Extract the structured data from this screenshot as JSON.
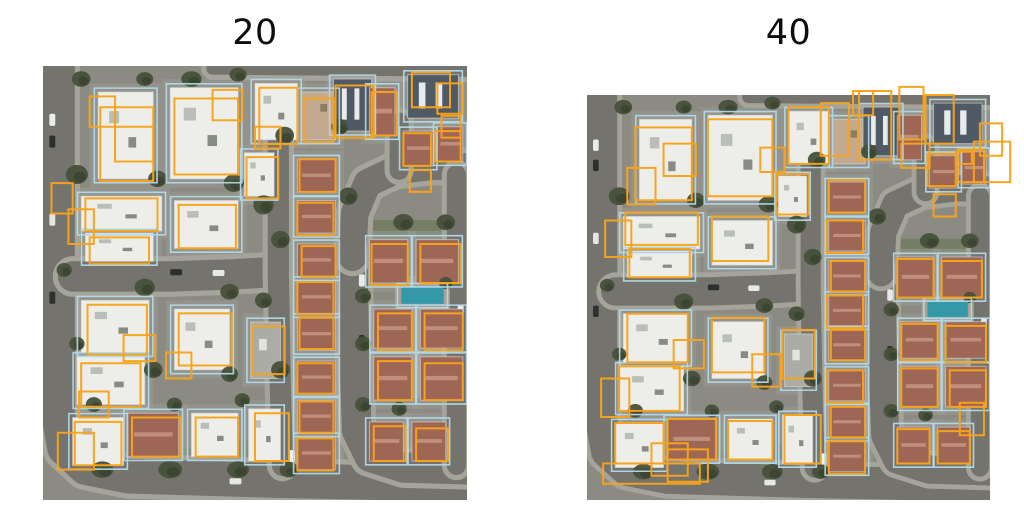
{
  "panels": [
    {
      "title": "20",
      "predicted_boxes": [
        [
          13.5,
          9.5,
          12.5,
          17
        ],
        [
          11,
          7,
          6,
          7
        ],
        [
          17,
          14,
          9,
          8
        ],
        [
          31,
          7.5,
          15,
          17.5
        ],
        [
          40,
          5.5,
          7,
          7
        ],
        [
          51,
          5,
          9,
          13
        ],
        [
          50,
          14,
          6,
          5
        ],
        [
          61.5,
          7.5,
          7,
          10
        ],
        [
          69,
          4.5,
          9,
          12
        ],
        [
          77.5,
          6,
          6,
          10
        ],
        [
          87,
          1.5,
          9,
          8
        ],
        [
          93,
          4,
          6,
          7
        ],
        [
          94,
          11.5,
          4.5,
          5
        ],
        [
          85,
          15.5,
          6.5,
          7.5
        ],
        [
          92.5,
          15,
          6,
          7
        ],
        [
          86.5,
          24,
          5,
          5
        ],
        [
          10,
          30.5,
          17,
          7.5
        ],
        [
          11,
          39.5,
          14,
          6
        ],
        [
          6,
          33,
          6,
          8
        ],
        [
          32,
          32,
          13.5,
          10
        ],
        [
          48,
          21,
          7.5,
          9.5
        ],
        [
          60.5,
          21.5,
          8.5,
          7.5
        ],
        [
          60,
          31.5,
          8.5,
          7.5
        ],
        [
          61,
          41.5,
          8,
          7
        ],
        [
          60,
          49.8,
          8.5,
          7.4
        ],
        [
          60.5,
          58,
          8,
          7.2
        ],
        [
          60,
          68.5,
          8.5,
          7
        ],
        [
          60.5,
          77.3,
          8,
          7.2
        ],
        [
          60,
          85.8,
          8.5,
          7.4
        ],
        [
          10.5,
          55,
          14,
          11.5
        ],
        [
          19,
          62,
          7.5,
          6
        ],
        [
          32,
          57,
          12.5,
          12
        ],
        [
          29,
          66,
          6,
          6
        ],
        [
          49.5,
          60,
          7.5,
          11
        ],
        [
          9,
          68.5,
          14,
          10
        ],
        [
          8.5,
          75,
          7,
          6
        ],
        [
          7.5,
          82,
          11,
          10
        ],
        [
          3.5,
          84.5,
          8.5,
          8.5
        ],
        [
          21,
          81,
          11.5,
          9
        ],
        [
          36,
          81,
          10,
          9
        ],
        [
          50,
          80,
          8,
          11
        ],
        [
          77.5,
          41,
          8.5,
          9.5
        ],
        [
          89,
          41,
          9.5,
          9
        ],
        [
          79,
          57,
          8,
          8.5
        ],
        [
          90,
          57,
          9,
          8.5
        ],
        [
          79,
          68,
          8,
          9
        ],
        [
          90,
          68.5,
          9,
          8.5
        ],
        [
          78,
          83,
          7.5,
          8
        ],
        [
          88,
          83.5,
          7.5,
          7.5
        ],
        [
          2,
          27,
          5,
          7
        ]
      ]
    },
    {
      "title": "40",
      "predicted_boxes": [
        [
          12,
          8,
          14,
          18
        ],
        [
          10,
          18,
          7,
          9
        ],
        [
          19,
          12,
          8,
          8
        ],
        [
          30,
          6,
          16,
          19
        ],
        [
          43,
          13,
          6,
          6
        ],
        [
          50,
          3,
          10,
          14
        ],
        [
          58,
          2,
          7,
          13
        ],
        [
          67.5,
          -1,
          8,
          17
        ],
        [
          77.5,
          -2,
          6,
          13
        ],
        [
          66,
          -1,
          5,
          6
        ],
        [
          84,
          0,
          7,
          12
        ],
        [
          91.5,
          14,
          4,
          3
        ],
        [
          78,
          12,
          7,
          6
        ],
        [
          97.5,
          7,
          5.5,
          8
        ],
        [
          96,
          11.5,
          9,
          10
        ],
        [
          84.5,
          14.5,
          7,
          8
        ],
        [
          92,
          13.5,
          6.5,
          8
        ],
        [
          86,
          24.5,
          5.5,
          5.5
        ],
        [
          9.5,
          29,
          18,
          8
        ],
        [
          10.5,
          38,
          15,
          7
        ],
        [
          4.5,
          31,
          6.5,
          9
        ],
        [
          31,
          30,
          14,
          11
        ],
        [
          47,
          19.5,
          8,
          10
        ],
        [
          60,
          21,
          9,
          8
        ],
        [
          59.5,
          31,
          9,
          8
        ],
        [
          60.5,
          41,
          8.5,
          7.5
        ],
        [
          59.5,
          49.5,
          9,
          8
        ],
        [
          60.5,
          58,
          8.5,
          7.5
        ],
        [
          59.5,
          68,
          9,
          8
        ],
        [
          60.5,
          77,
          8.5,
          7.5
        ],
        [
          60,
          85.5,
          9,
          8
        ],
        [
          10,
          54,
          15,
          12
        ],
        [
          21.5,
          60.5,
          7.5,
          7
        ],
        [
          31,
          55,
          13,
          13.5
        ],
        [
          41,
          64,
          7,
          8
        ],
        [
          48.5,
          58,
          8,
          12
        ],
        [
          8,
          67,
          15,
          11
        ],
        [
          3.5,
          70,
          7,
          9.5
        ],
        [
          7,
          81,
          12,
          10
        ],
        [
          16,
          86,
          9,
          8
        ],
        [
          20,
          80,
          12,
          10
        ],
        [
          20,
          87.5,
          10,
          8
        ],
        [
          35,
          80.5,
          11,
          9.5
        ],
        [
          49,
          79,
          9,
          12
        ],
        [
          4,
          91,
          24,
          5
        ],
        [
          77,
          40.5,
          9,
          9.5
        ],
        [
          88,
          41,
          10,
          9
        ],
        [
          78,
          56.5,
          9,
          9
        ],
        [
          89,
          57,
          10,
          9
        ],
        [
          78,
          67.5,
          9,
          9.5
        ],
        [
          90,
          68,
          9,
          9
        ],
        [
          77,
          82.5,
          8,
          8.5
        ],
        [
          87,
          83,
          8,
          8
        ],
        [
          92.5,
          76,
          6,
          8
        ]
      ]
    }
  ],
  "colors": {
    "prediction_orange": "#F9A31B",
    "ground_truth_cyan": "#B2D9E8",
    "ground": "#8C8B83",
    "lot_pad": "#9C9B93",
    "road": "#74736D",
    "curb": "#A5A49B",
    "lawn": "#6F7A5E",
    "tree": "#47503A",
    "tree_dark": "#3A422F",
    "pool": "#3498A8",
    "pave": "#A9A296",
    "roof_white": "#EDEEE9",
    "roof_terra": "#9E6655",
    "roof_tan": "#C2A98F",
    "roof_slate": "#4F5A64",
    "roof_gray": "#ABACA6",
    "detail_gray": "#B9BEB8",
    "detail_dark": "#868B83",
    "terra_ridge": "#BF8F7B",
    "slate_panel": "#E8EBEC",
    "tan_dark": "#8D7C64",
    "gray_light": "#E2E3DF",
    "title_color": "#0D0D0D"
  },
  "scene": {
    "houses": [
      {
        "r": [
          13,
          6,
          13,
          20
        ],
        "c": "white"
      },
      {
        "r": [
          30,
          5,
          16,
          21
        ],
        "c": "white"
      },
      {
        "r": [
          50,
          4,
          10,
          13
        ],
        "c": "white"
      },
      {
        "r": [
          61,
          6,
          8,
          11
        ],
        "c": "tan"
      },
      {
        "r": [
          68.5,
          3,
          9,
          12
        ],
        "c": "slate"
      },
      {
        "r": [
          77,
          5,
          6,
          11
        ],
        "c": "terra"
      },
      {
        "r": [
          86,
          2,
          12,
          10
        ],
        "c": "slate"
      },
      {
        "r": [
          85,
          15,
          7,
          8
        ],
        "c": "terra"
      },
      {
        "r": [
          93,
          14,
          6,
          8
        ],
        "c": "terra"
      },
      {
        "r": [
          9,
          30,
          19,
          8
        ],
        "c": "white"
      },
      {
        "r": [
          10,
          38.5,
          16,
          6.5
        ],
        "c": "white"
      },
      {
        "r": [
          31,
          31,
          15,
          11
        ],
        "c": "white"
      },
      {
        "r": [
          47.5,
          20,
          7,
          10
        ],
        "c": "white"
      },
      {
        "r": [
          60,
          21.5,
          9,
          7.5
        ],
        "c": "terra"
      },
      {
        "r": [
          60,
          31,
          9,
          7.5
        ],
        "c": "terra"
      },
      {
        "r": [
          60,
          41,
          9,
          7.5
        ],
        "c": "terra"
      },
      {
        "r": [
          60,
          49.5,
          9,
          7.5
        ],
        "c": "terra"
      },
      {
        "r": [
          60,
          58,
          9,
          7.5
        ],
        "c": "terra"
      },
      {
        "r": [
          60,
          68,
          9,
          7.5
        ],
        "c": "terra"
      },
      {
        "r": [
          60,
          77,
          9,
          7.5
        ],
        "c": "terra"
      },
      {
        "r": [
          60,
          85.5,
          9,
          7.5
        ],
        "c": "terra"
      },
      {
        "r": [
          9,
          54,
          16,
          12
        ],
        "c": "white"
      },
      {
        "r": [
          31,
          56,
          13,
          14
        ],
        "c": "white"
      },
      {
        "r": [
          49,
          59,
          7,
          13
        ],
        "c": "gray"
      },
      {
        "r": [
          8,
          67,
          16,
          11
        ],
        "c": "white"
      },
      {
        "r": [
          7,
          81,
          12,
          11
        ],
        "c": "white"
      },
      {
        "r": [
          20,
          80,
          12,
          10
        ],
        "c": "terra"
      },
      {
        "r": [
          35,
          80,
          11,
          10
        ],
        "c": "white"
      },
      {
        "r": [
          48.5,
          79,
          7.5,
          12
        ],
        "c": "white"
      },
      {
        "r": [
          77,
          40,
          9,
          10
        ],
        "c": "terra"
      },
      {
        "r": [
          88,
          40,
          10,
          10
        ],
        "c": "terra"
      },
      {
        "r": [
          78,
          56,
          9,
          9
        ],
        "c": "terra"
      },
      {
        "r": [
          89,
          56,
          10,
          9
        ],
        "c": "terra"
      },
      {
        "r": [
          78,
          67,
          9,
          10
        ],
        "c": "terra"
      },
      {
        "r": [
          89,
          67,
          10,
          10
        ],
        "c": "terra"
      },
      {
        "r": [
          77,
          82,
          8,
          9
        ],
        "c": "terra"
      },
      {
        "r": [
          87,
          82,
          8,
          9
        ],
        "c": "terra"
      }
    ],
    "roads": [
      {
        "pts": [
          [
            3.5,
            -3
          ],
          [
            3.5,
            80
          ],
          [
            5,
            88
          ],
          [
            10,
            92.5
          ],
          [
            20,
            94.5
          ],
          [
            55,
            95.5
          ],
          [
            103,
            96.5
          ]
        ],
        "w": 8
      },
      {
        "pts": [
          [
            7,
            48.5
          ],
          [
            30,
            48.5
          ],
          [
            45,
            48
          ],
          [
            54,
            47.5
          ]
        ],
        "w": 7
      },
      {
        "pts": [
          [
            55.5,
            17
          ],
          [
            55.5,
            48
          ],
          [
            56,
            75
          ],
          [
            56.5,
            92
          ]
        ],
        "w": 5
      },
      {
        "pts": [
          [
            73,
            42
          ],
          [
            73.5,
            70
          ],
          [
            74,
            84
          ],
          [
            77,
            90
          ],
          [
            85,
            92.5
          ],
          [
            103,
            93
          ]
        ],
        "w": 7
      },
      {
        "pts": [
          [
            73,
            44
          ],
          [
            73.5,
            34
          ],
          [
            76.5,
            27
          ],
          [
            83,
            24
          ],
          [
            92,
            23
          ],
          [
            103,
            23.5
          ]
        ],
        "w": 6.5
      },
      {
        "pts": [
          [
            84,
            13
          ],
          [
            84,
            24
          ]
        ],
        "w": 4.5
      },
      {
        "pts": [
          [
            40,
            0.5
          ],
          [
            103,
            1
          ]
        ],
        "w": 3
      },
      {
        "pts": [
          [
            97.5,
            25
          ],
          [
            97.5,
            92
          ]
        ],
        "w": 4.5
      }
    ],
    "lawns": [
      [
        6,
        88,
        26,
        6.5
      ],
      [
        33,
        88,
        22,
        6.5
      ],
      [
        76,
        35.5,
        22,
        4
      ],
      [
        77,
        91.5,
        18,
        4
      ],
      [
        44,
        86,
        9,
        8
      ]
    ],
    "paves": [
      [
        86.5,
        56.5,
        2.5,
        20
      ],
      [
        83,
        48.5,
        13,
        8
      ]
    ],
    "pool": [
      84.5,
      51,
      10,
      3.8
    ],
    "trees": [
      [
        8,
        25,
        2.6,
        2.2
      ],
      [
        27,
        26,
        2.2,
        1.9
      ],
      [
        45,
        27,
        2.4,
        2
      ],
      [
        57,
        16,
        2.2,
        2
      ],
      [
        5,
        47,
        1.8,
        1.6
      ],
      [
        24,
        51,
        2.4,
        2
      ],
      [
        44,
        52,
        2.2,
        1.8
      ],
      [
        52,
        54,
        2,
        1.8
      ],
      [
        8,
        64,
        1.8,
        1.6
      ],
      [
        26,
        70,
        2.2,
        1.9
      ],
      [
        44,
        71,
        2,
        1.8
      ],
      [
        56,
        70,
        2.2,
        2
      ],
      [
        12,
        78,
        1.9,
        1.7
      ],
      [
        31,
        78,
        1.8,
        1.6
      ],
      [
        47,
        77,
        1.8,
        1.6
      ],
      [
        14,
        93,
        2.6,
        1.9
      ],
      [
        30,
        93,
        2.8,
        2
      ],
      [
        46,
        93,
        2.6,
        1.9
      ],
      [
        58,
        93,
        2.2,
        1.8
      ],
      [
        52,
        32,
        2.4,
        2.2
      ],
      [
        56,
        40,
        2.2,
        2
      ],
      [
        70,
        14,
        2,
        1.8
      ],
      [
        72,
        30,
        2.2,
        2
      ],
      [
        75.5,
        53,
        1.9,
        1.7
      ],
      [
        75.5,
        64,
        1.9,
        1.7
      ],
      [
        75.5,
        78,
        1.9,
        1.7
      ],
      [
        85,
        36,
        2.4,
        1.9
      ],
      [
        95,
        36,
        2.2,
        1.8
      ],
      [
        84,
        79,
        1.8,
        1.6
      ],
      [
        95,
        50,
        1.6,
        1.4
      ],
      [
        35,
        3,
        2.4,
        1.8
      ],
      [
        46,
        2,
        2,
        1.6
      ],
      [
        24,
        3,
        2,
        1.6
      ],
      [
        9,
        3,
        2.2,
        1.8
      ]
    ],
    "cars": [
      [
        1.5,
        11,
        1.4,
        2.8,
        "#ECECEC"
      ],
      [
        1.5,
        16,
        1.4,
        2.8,
        "#2E2E2E"
      ],
      [
        1.5,
        34,
        1.4,
        2.8,
        "#E5E5E5"
      ],
      [
        1.5,
        52,
        1.4,
        2.8,
        "#303030"
      ],
      [
        30,
        46.8,
        2.8,
        1.4,
        "#2E2E2E"
      ],
      [
        40,
        47,
        2.8,
        1.4,
        "#E8E8E8"
      ],
      [
        74.5,
        48,
        1.4,
        2.8,
        "#E9E9E9"
      ],
      [
        74.5,
        62,
        1.4,
        2.8,
        "#2C2C2C"
      ],
      [
        58,
        88.5,
        1.4,
        2.8,
        "#F0F0F0"
      ],
      [
        97.8,
        55,
        1.4,
        2.8,
        "#E8E8E8"
      ],
      [
        97.8,
        70,
        1.4,
        2.8,
        "#2D2D2D"
      ],
      [
        44,
        95,
        2.8,
        1.4,
        "#E8E8E8"
      ]
    ]
  }
}
